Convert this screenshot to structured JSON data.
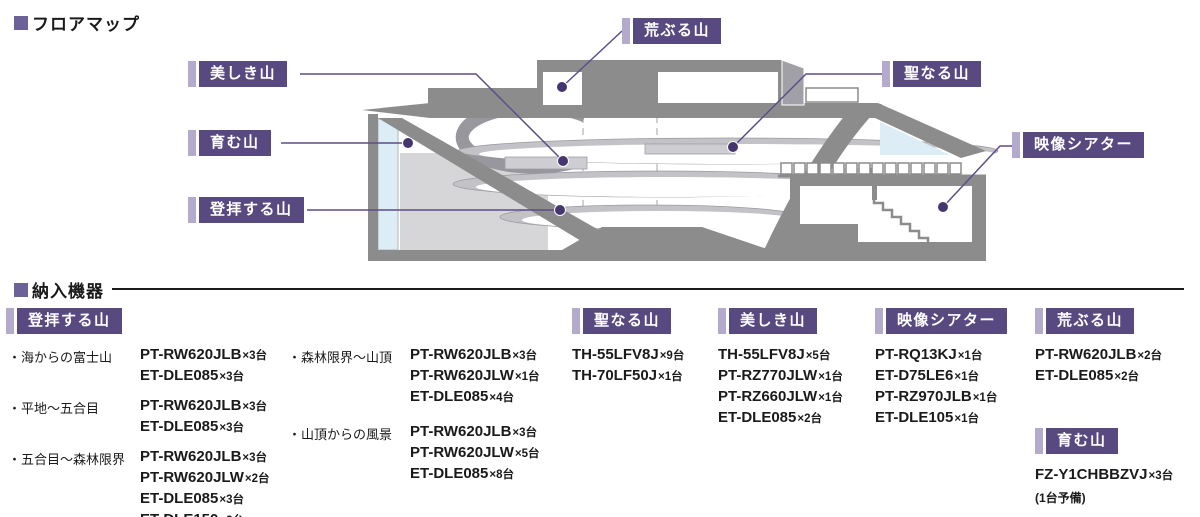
{
  "titles": {
    "floor_map": "フロアマップ",
    "equipment": "納入機器"
  },
  "map_labels": {
    "araburu": "荒ぶる山",
    "utsukushiki": "美しき山",
    "hijiri": "聖なる山",
    "hagukumu": "育む山",
    "tohai": "登拝する山",
    "theater": "映像シアター"
  },
  "equipment": {
    "tohai": {
      "header": "登拝する山",
      "groups": [
        {
          "label": "・海からの富士山",
          "items": [
            {
              "model": "PT-RW620JLB",
              "qty": "×3台"
            },
            {
              "model": "ET-DLE085",
              "qty": "×3台"
            }
          ]
        },
        {
          "label": "・平地〜五合目",
          "items": [
            {
              "model": "PT-RW620JLB",
              "qty": "×3台"
            },
            {
              "model": "ET-DLE085",
              "qty": "×3台"
            }
          ]
        },
        {
          "label": "・五合目〜森林限界",
          "items": [
            {
              "model": "PT-RW620JLB",
              "qty": "×3台"
            },
            {
              "model": "PT-RW620JLW",
              "qty": "×2台"
            },
            {
              "model": "ET-DLE085",
              "qty": "×3台"
            },
            {
              "model": "ET-DLE150",
              "qty": "×2台"
            }
          ]
        },
        {
          "label": "・森林限界〜山頂",
          "items": [
            {
              "model": "PT-RW620JLB",
              "qty": "×3台"
            },
            {
              "model": "PT-RW620JLW",
              "qty": "×1台"
            },
            {
              "model": "ET-DLE085",
              "qty": "×4台"
            }
          ]
        },
        {
          "label": "・山頂からの風景",
          "items": [
            {
              "model": "PT-RW620JLB",
              "qty": "×3台"
            },
            {
              "model": "PT-RW620JLW",
              "qty": "×5台"
            },
            {
              "model": "ET-DLE085",
              "qty": "×8台"
            }
          ]
        }
      ]
    },
    "hijiri": {
      "header": "聖なる山",
      "items": [
        {
          "model": "TH-55LFV8J",
          "qty": "×9台"
        },
        {
          "model": "TH-70LF50J",
          "qty": "×1台"
        }
      ]
    },
    "utsukushiki": {
      "header": "美しき山",
      "items": [
        {
          "model": "TH-55LFV8J",
          "qty": "×5台"
        },
        {
          "model": "PT-RZ770JLW",
          "qty": "×1台"
        },
        {
          "model": "PT-RZ660JLW",
          "qty": "×1台"
        },
        {
          "model": "ET-DLE085",
          "qty": "×2台"
        }
      ]
    },
    "theater": {
      "header": "映像シアター",
      "items": [
        {
          "model": "PT-RQ13KJ",
          "qty": "×1台"
        },
        {
          "model": "ET-D75LE6",
          "qty": "×1台"
        },
        {
          "model": "PT-RZ970JLB",
          "qty": "×1台"
        },
        {
          "model": "ET-DLE105",
          "qty": "×1台"
        }
      ]
    },
    "araburu": {
      "header": "荒ぶる山",
      "items": [
        {
          "model": "PT-RW620JLB",
          "qty": "×2台"
        },
        {
          "model": "ET-DLE085",
          "qty": "×2台"
        }
      ]
    },
    "hagukumu": {
      "header": "育む山",
      "items": [
        {
          "model": "FZ-Y1CHBBZVJ",
          "qty": "×3台"
        }
      ],
      "note": "(1台予備)"
    }
  },
  "colors": {
    "label_bg": "#584a80",
    "label_bar": "#b4abcc",
    "leader_line": "#5c4d8c",
    "dot": "#46366f",
    "section_square": "#6c6198",
    "wall_gray": "#8c8c8c",
    "light_gray": "#d6d6d9",
    "glass_blue": "#ddedf6"
  }
}
